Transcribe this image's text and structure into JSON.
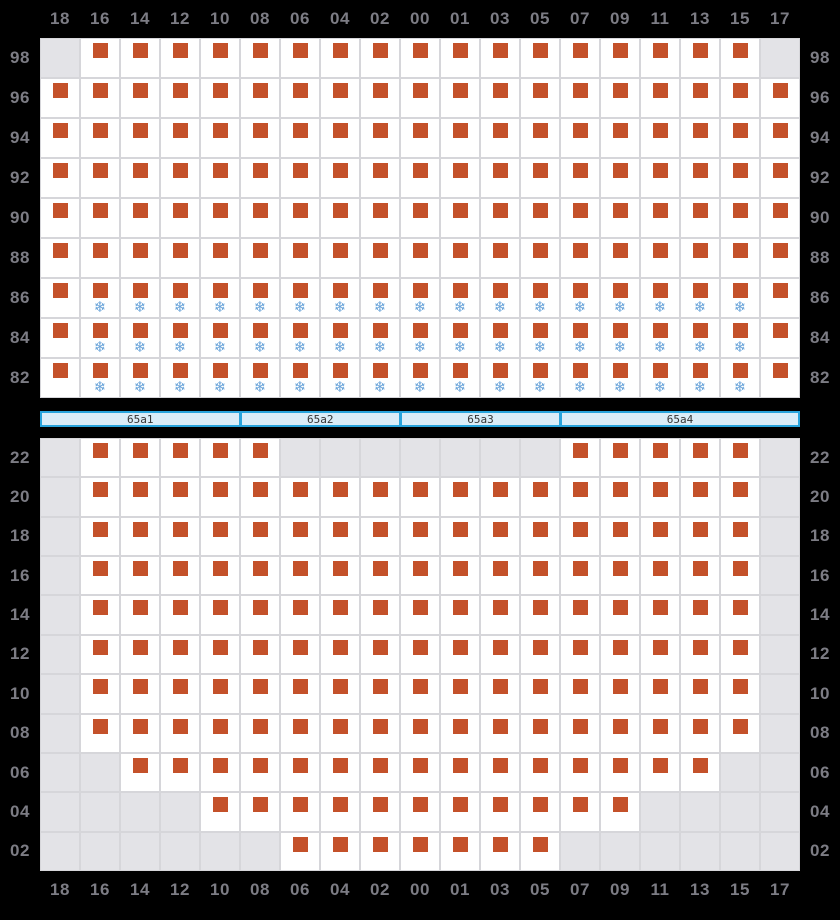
{
  "colors": {
    "background": "#000000",
    "cell_bg": "#ffffff",
    "cell_empty_bg": "#e3e3e7",
    "cell_border": "#d6d6da",
    "square": "#c4512a",
    "snowflake": "#68a3d9",
    "label": "#7c7c84",
    "bar_bg": "#daedf8",
    "bar_border": "#29a4dc",
    "bar_text": "#333333"
  },
  "icons": {
    "marker": "square-icon",
    "frost": "snowflake-icon"
  },
  "chart_data": {
    "type": "heatmap",
    "snowflake_glyph": "❄",
    "cell_states": [
      "no-data",
      "square-marker",
      "square-marker-with-snowflake"
    ],
    "columns": [
      "18",
      "16",
      "14",
      "12",
      "10",
      "08",
      "06",
      "04",
      "02",
      "00",
      "01",
      "03",
      "05",
      "07",
      "09",
      "11",
      "13",
      "15",
      "17"
    ],
    "top": {
      "rows": [
        "98",
        "96",
        "94",
        "92",
        "90",
        "88",
        "86",
        "84",
        "82"
      ],
      "values": [
        [
          0,
          1,
          1,
          1,
          1,
          1,
          1,
          1,
          1,
          1,
          1,
          1,
          1,
          1,
          1,
          1,
          1,
          1,
          0
        ],
        [
          1,
          1,
          1,
          1,
          1,
          1,
          1,
          1,
          1,
          1,
          1,
          1,
          1,
          1,
          1,
          1,
          1,
          1,
          1
        ],
        [
          1,
          1,
          1,
          1,
          1,
          1,
          1,
          1,
          1,
          1,
          1,
          1,
          1,
          1,
          1,
          1,
          1,
          1,
          1
        ],
        [
          1,
          1,
          1,
          1,
          1,
          1,
          1,
          1,
          1,
          1,
          1,
          1,
          1,
          1,
          1,
          1,
          1,
          1,
          1
        ],
        [
          1,
          1,
          1,
          1,
          1,
          1,
          1,
          1,
          1,
          1,
          1,
          1,
          1,
          1,
          1,
          1,
          1,
          1,
          1
        ],
        [
          1,
          1,
          1,
          1,
          1,
          1,
          1,
          1,
          1,
          1,
          1,
          1,
          1,
          1,
          1,
          1,
          1,
          1,
          1
        ],
        [
          1,
          2,
          2,
          2,
          2,
          2,
          2,
          2,
          2,
          2,
          2,
          2,
          2,
          2,
          2,
          2,
          2,
          2,
          1
        ],
        [
          1,
          2,
          2,
          2,
          2,
          2,
          2,
          2,
          2,
          2,
          2,
          2,
          2,
          2,
          2,
          2,
          2,
          2,
          1
        ],
        [
          1,
          2,
          2,
          2,
          2,
          2,
          2,
          2,
          2,
          2,
          2,
          2,
          2,
          2,
          2,
          2,
          2,
          2,
          1
        ]
      ]
    },
    "separator_segments": [
      {
        "label": "65a1",
        "span": 5
      },
      {
        "label": "65a2",
        "span": 4
      },
      {
        "label": "65a3",
        "span": 4
      },
      {
        "label": "65a4",
        "span": 6
      }
    ],
    "bottom": {
      "rows": [
        "22",
        "20",
        "18",
        "16",
        "14",
        "12",
        "10",
        "08",
        "06",
        "04",
        "02"
      ],
      "values": [
        [
          0,
          1,
          1,
          1,
          1,
          1,
          0,
          0,
          0,
          0,
          0,
          0,
          0,
          1,
          1,
          1,
          1,
          1,
          0
        ],
        [
          0,
          1,
          1,
          1,
          1,
          1,
          1,
          1,
          1,
          1,
          1,
          1,
          1,
          1,
          1,
          1,
          1,
          1,
          0
        ],
        [
          0,
          1,
          1,
          1,
          1,
          1,
          1,
          1,
          1,
          1,
          1,
          1,
          1,
          1,
          1,
          1,
          1,
          1,
          0
        ],
        [
          0,
          1,
          1,
          1,
          1,
          1,
          1,
          1,
          1,
          1,
          1,
          1,
          1,
          1,
          1,
          1,
          1,
          1,
          0
        ],
        [
          0,
          1,
          1,
          1,
          1,
          1,
          1,
          1,
          1,
          1,
          1,
          1,
          1,
          1,
          1,
          1,
          1,
          1,
          0
        ],
        [
          0,
          1,
          1,
          1,
          1,
          1,
          1,
          1,
          1,
          1,
          1,
          1,
          1,
          1,
          1,
          1,
          1,
          1,
          0
        ],
        [
          0,
          1,
          1,
          1,
          1,
          1,
          1,
          1,
          1,
          1,
          1,
          1,
          1,
          1,
          1,
          1,
          1,
          1,
          0
        ],
        [
          0,
          1,
          1,
          1,
          1,
          1,
          1,
          1,
          1,
          1,
          1,
          1,
          1,
          1,
          1,
          1,
          1,
          1,
          0
        ],
        [
          0,
          0,
          1,
          1,
          1,
          1,
          1,
          1,
          1,
          1,
          1,
          1,
          1,
          1,
          1,
          1,
          1,
          0,
          0
        ],
        [
          0,
          0,
          0,
          0,
          1,
          1,
          1,
          1,
          1,
          1,
          1,
          1,
          1,
          1,
          1,
          0,
          0,
          0,
          0
        ],
        [
          0,
          0,
          0,
          0,
          0,
          0,
          1,
          1,
          1,
          1,
          1,
          1,
          1,
          0,
          0,
          0,
          0,
          0,
          0
        ]
      ]
    }
  }
}
